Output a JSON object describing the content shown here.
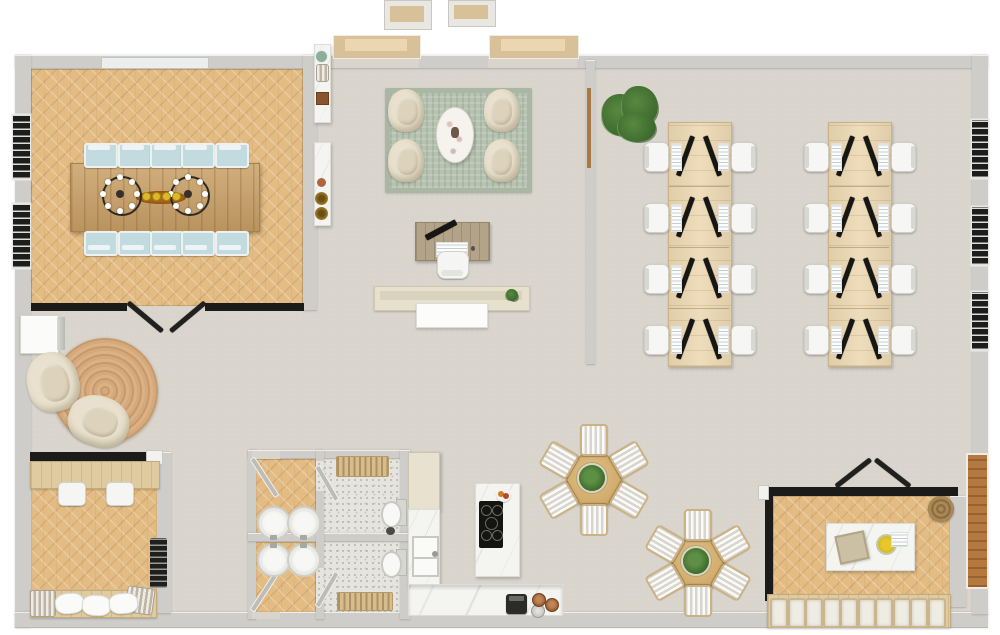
{
  "title": "Office floor plan",
  "palette": {
    "bg": "#ffffff",
    "exterior_wall": "#cecdc9",
    "glass_partition": "#1b1b19",
    "floor_main": "#d9d5cd",
    "floor_wood": "#e3bc84",
    "conference_table_wood": "#c9a066",
    "office_desk_wood": "#ecd8b2",
    "chair_upholstery_blue": "#c2dbde",
    "lounge_rug_sage": "#b7c3b1",
    "armchair_cream": "#e9e1cd",
    "jute_rug": "#d6a97c",
    "entry_step_tan": "#d8c098",
    "marble_white": "#f4f4f1",
    "plant_green": "#57893f",
    "wood_door": "#b5793f"
  },
  "rooms": [
    "conference-room",
    "lounge",
    "reception",
    "open-office",
    "reading-nook",
    "study-room",
    "washrooms",
    "kitchen",
    "dining-area",
    "meeting-room"
  ],
  "inventory": {
    "conference": {
      "chairs_per_side": 5,
      "chair_rows": 2,
      "chandeliers": 2,
      "chandelier_bulbs": 8,
      "centerpiece_flowers": 4,
      "left_wall_windows": 2,
      "glass_door_leaves": 2,
      "console_tables": 2
    },
    "lounge": {
      "armchairs": 4,
      "coffee_tables": 1,
      "entry_steps": 2
    },
    "reception": {
      "desks": 1,
      "monitors": 1,
      "chairs": 1,
      "counters": 1,
      "plants": 1
    },
    "open_office": {
      "desk_banks": 2,
      "rows_per_bank": 4,
      "seats": 16,
      "monitors": 16,
      "floor_plants": 1,
      "right_wall_windows": 3
    },
    "reading_nook": {
      "armchairs": 2,
      "round_rugs": 1,
      "cabinets": 1
    },
    "study_room": {
      "desk_chairs": 2,
      "stoves": 1,
      "bench_pillows": 3,
      "baskets": 2
    },
    "washrooms": {
      "sinks": 4,
      "toilets": 2,
      "radiators": 2,
      "door_leaves": 4
    },
    "kitchen": {
      "islands": 1,
      "burner_rings": 5,
      "sink_basins": 2,
      "tall_cabinets": 1,
      "coffee_machines": 1,
      "cups": 2
    },
    "dining": {
      "tables": 2,
      "chairs_per_table": 6,
      "planters": 2
    },
    "meeting_room": {
      "tables": 1,
      "stools": 10,
      "glass_door_leaves": 2,
      "baskets": 1
    }
  }
}
